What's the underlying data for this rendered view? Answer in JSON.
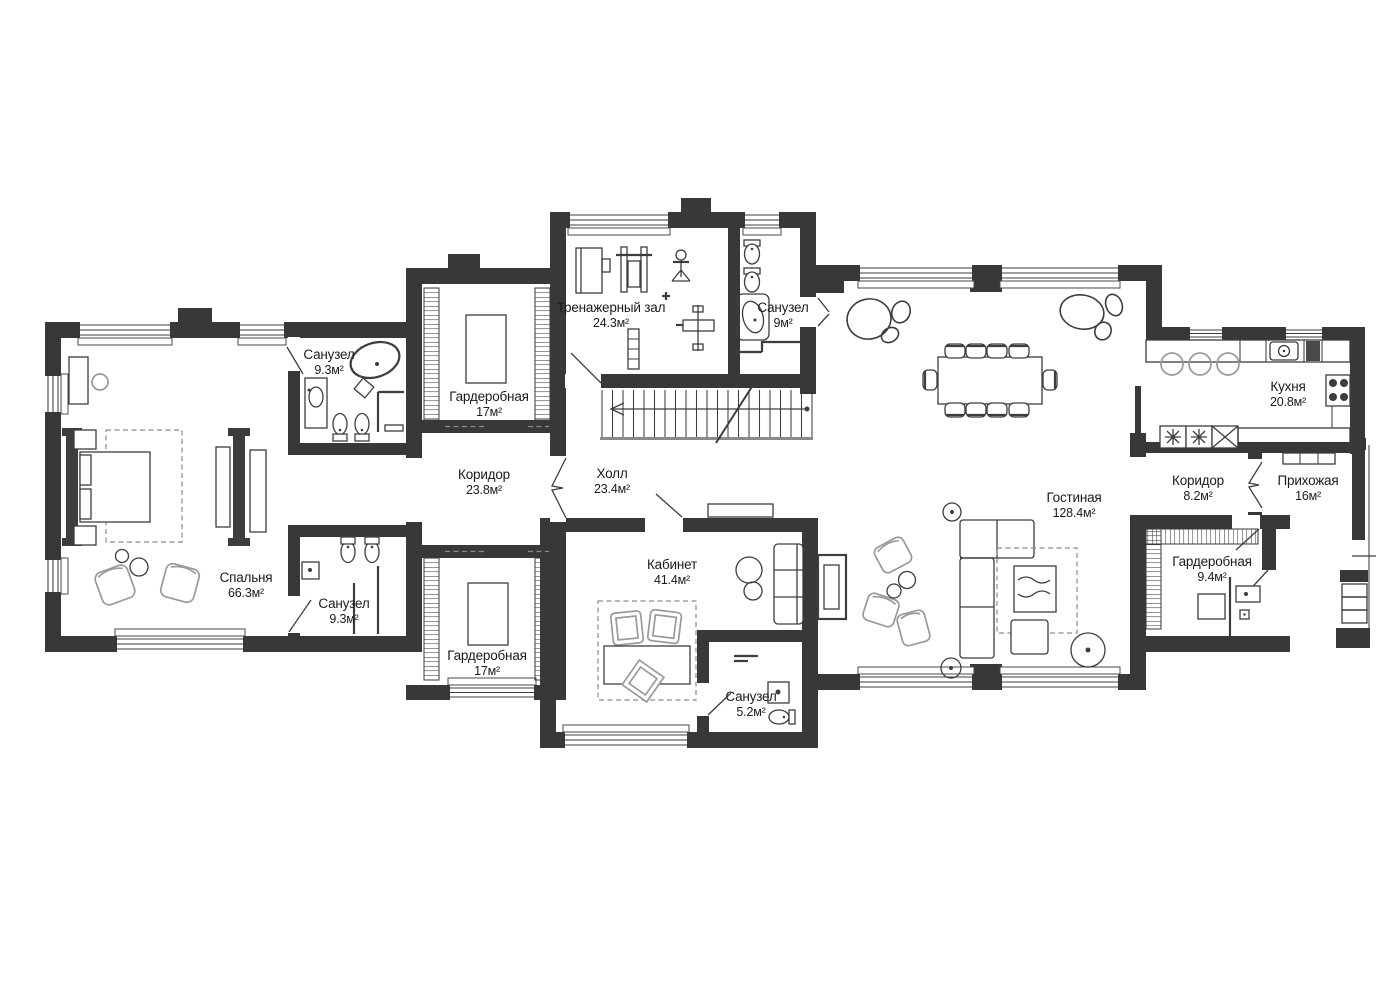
{
  "plan": {
    "type": "floor-plan",
    "language": "ru",
    "palette": {
      "wall": "#383838",
      "furniture_line": "#3d3d3d",
      "light_furniture_line": "#9a9a9a",
      "text": "#1b1b1b",
      "background": "#ffffff"
    },
    "rooms": [
      {
        "id": "bedroom",
        "name": "Спальня",
        "area": "66.3м²"
      },
      {
        "id": "bath-master-top",
        "name": "Санузел",
        "area": "9.3м²"
      },
      {
        "id": "wardrobe-top",
        "name": "Гардеробная",
        "area": "17м²"
      },
      {
        "id": "gym",
        "name": "Тренажерный зал",
        "area": "24.3м²"
      },
      {
        "id": "bath-gym",
        "name": "Санузел",
        "area": "9м²"
      },
      {
        "id": "corridor-main",
        "name": "Коридор",
        "area": "23.8м²"
      },
      {
        "id": "hall",
        "name": "Холл",
        "area": "23.4м²"
      },
      {
        "id": "bath-master-bottom",
        "name": "Санузел",
        "area": "9.3м²"
      },
      {
        "id": "wardrobe-bottom",
        "name": "Гардеробная",
        "area": "17м²"
      },
      {
        "id": "office",
        "name": "Кабинет",
        "area": "41.4м²"
      },
      {
        "id": "bath-office",
        "name": "Санузел",
        "area": "5.2м²"
      },
      {
        "id": "living-room",
        "name": "Гостиная",
        "area": "128.4м²"
      },
      {
        "id": "kitchen",
        "name": "Кухня",
        "area": "20.8м²"
      },
      {
        "id": "corridor-entry",
        "name": "Коридор",
        "area": "8.2м²"
      },
      {
        "id": "entry-hall",
        "name": "Прихожая",
        "area": "16м²"
      },
      {
        "id": "wardrobe-entry",
        "name": "Гардеробная",
        "area": "9.4м²"
      }
    ]
  }
}
